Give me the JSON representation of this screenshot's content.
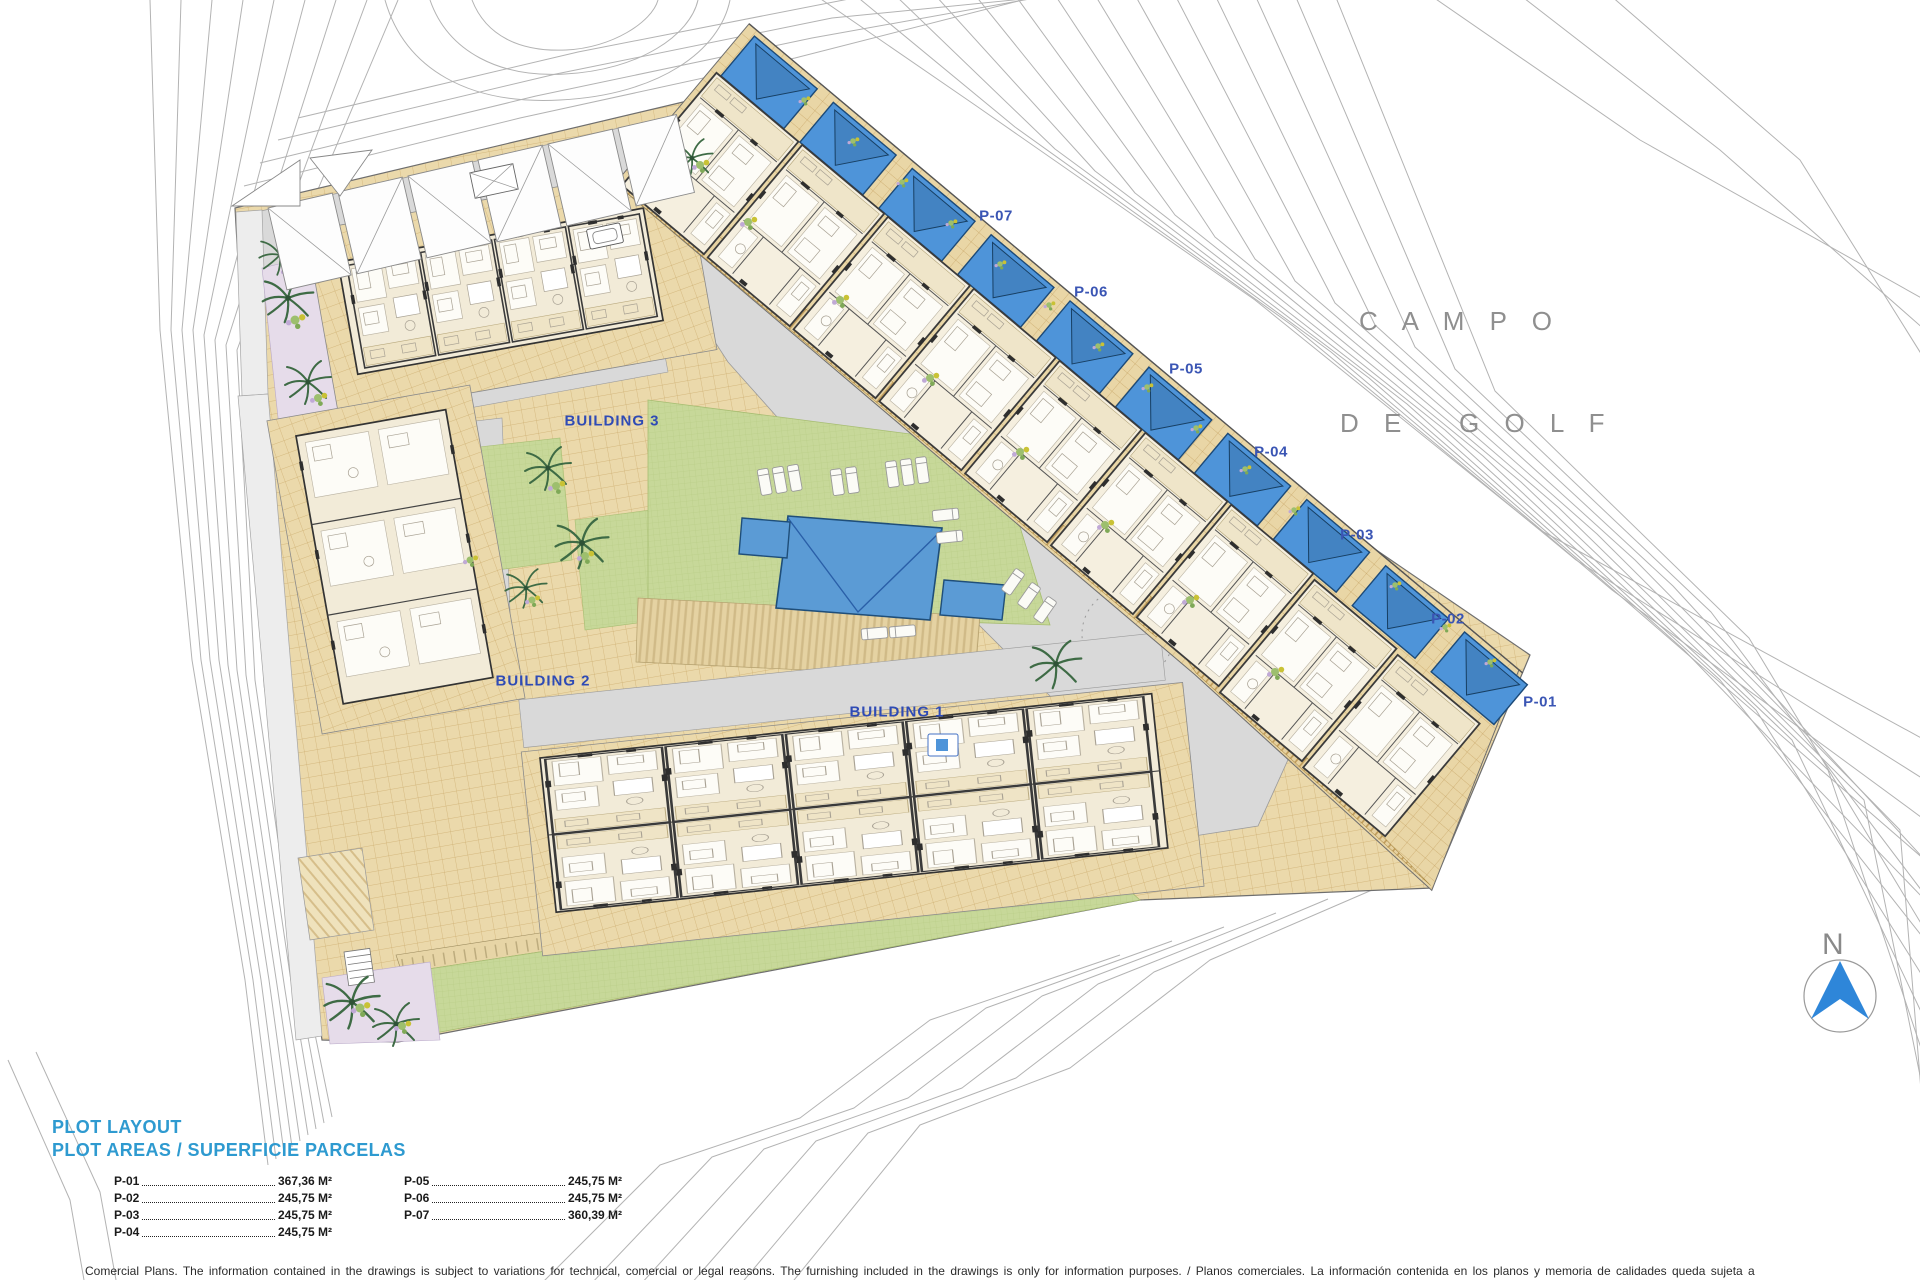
{
  "plan": {
    "golf": {
      "line1": "C A M P O",
      "line2": "D E   G O L F"
    },
    "north_label": "N",
    "building_labels": {
      "b1": "BUILDING 1",
      "b2": "BUILDING 2",
      "b3": "BUILDING 3"
    },
    "plot_labels": [
      "P-07",
      "P-06",
      "P-05",
      "P-04",
      "P-03",
      "P-02",
      "P-01"
    ],
    "colors": {
      "plot_label": "#3a55b4",
      "building_label": "#2f4bb5",
      "legend_heading": "#2e9ad0",
      "pool_blue": "#4e94d9",
      "paving_tan": "#ebd9ab",
      "lawn_green": "#c7d899",
      "road_gray": "#d9d9d9",
      "golf_text": "#8f8f8f",
      "north_arrow_blue": "#2e86d9"
    }
  },
  "legend": {
    "title": "PLOT LAYOUT",
    "subtitle": "PLOT AREAS / SUPERFICIE PARCELAS",
    "left": [
      {
        "plot": "P-01",
        "area": "367,36 M²"
      },
      {
        "plot": "P-02",
        "area": "245,75 M²"
      },
      {
        "plot": "P-03",
        "area": "245,75 M²"
      },
      {
        "plot": "P-04",
        "area": "245,75 M²"
      }
    ],
    "right": [
      {
        "plot": "P-05",
        "area": "245,75 M²"
      },
      {
        "plot": "P-06",
        "area": "245,75 M²"
      },
      {
        "plot": "P-07",
        "area": "360,39 M²"
      }
    ]
  },
  "footer": {
    "line1": "Comercial Plans. The information contained in the drawings is subject to variations for technical, comercial or legal reasons. The furnishing included in the drawings is only for information purposes. / Planos comerciales. La información contenida en los planos y memoria de calidades queda sujeta a",
    "line2": "variaciones por motivos técnicos, comerciales o legales. El mobiliario incluido en los planos es únicamente a efectos informativos."
  }
}
